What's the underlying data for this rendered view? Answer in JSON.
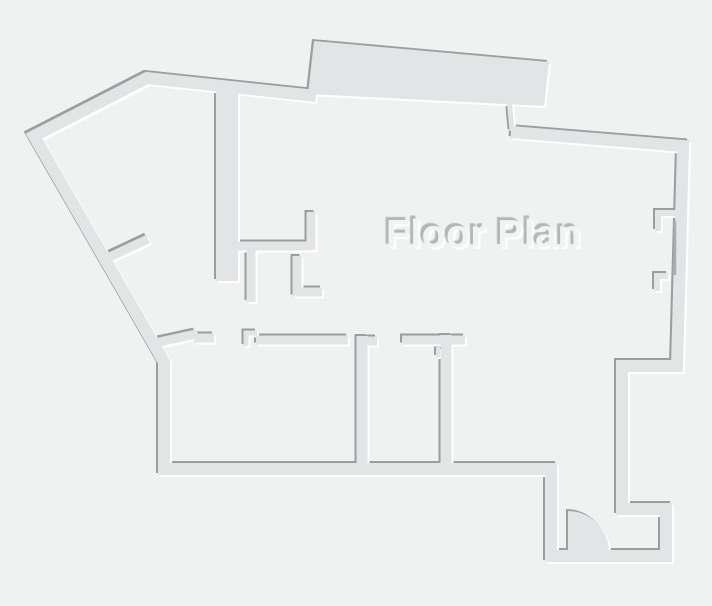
{
  "title": {
    "text": "Floor Plan"
  },
  "canvas": {
    "width": 712,
    "height": 606
  },
  "colors": {
    "background": "#f0f1f1",
    "wall": "#e2e4e5",
    "shadow_dark": "#9b9d9e",
    "shadow_light": "#ffffff",
    "title_fill": "#f2f3f3",
    "title_shadow": "#b5b7b7",
    "glazing_line": "#aaacad"
  },
  "floor_plan": {
    "outline_walls": [
      {
        "name": "exterior-outline",
        "d": "M 511,132 L 683,146 L 677,366 L 622,366 L 622,509 L 666,509 L 666,556 L 551,556 L 551,469 L 164,469 L 164,362 L 34,136 L 147,78 L 316,96",
        "width": 12
      },
      {
        "name": "slab-connector-wall",
        "d": "M 509,97 L 512,131",
        "width": 5
      },
      {
        "name": "interior-thick-wall",
        "d": "M 227,84 L 227,281",
        "width": 22
      },
      {
        "name": "closet-top-wall",
        "d": "M 238,246 L 311,246",
        "width": 9
      },
      {
        "name": "closet-upper-stub",
        "d": "M 311,250 L 311,212",
        "width": 9
      },
      {
        "name": "closet-left-stub",
        "d": "M 251,250 L 251,302",
        "width": 9
      },
      {
        "name": "closet-right-stub",
        "d": "M 297,256 L 297,292 L 322,292",
        "width": 9
      },
      {
        "name": "entry-diagonal-stub",
        "d": "M 101,261 L 148,239",
        "width": 9
      },
      {
        "name": "room1-diagonal-wall",
        "d": "M 150,344 L 196,334",
        "width": 9
      },
      {
        "name": "room1-top-wall",
        "d": "M 194,338 L 214,338",
        "width": 9
      },
      {
        "name": "room1-door-jamb",
        "d": "M 246,346 L 246,333 L 257,333",
        "width": 5
      },
      {
        "name": "room2-top-wall",
        "d": "M 256,340 L 348,340",
        "width": 9
      },
      {
        "name": "partition-wall-1",
        "d": "M 362,336 L 362,468",
        "width": 11
      },
      {
        "name": "partition-1-stub",
        "d": "M 357,341 L 377,341",
        "width": 9
      },
      {
        "name": "room3-top-wall",
        "d": "M 402,340 L 465,340",
        "width": 9
      },
      {
        "name": "room3-mini-stub",
        "d": "M 438,347 L 438,357",
        "width": 4
      },
      {
        "name": "partition-wall-2",
        "d": "M 446,335 L 446,468",
        "width": 11
      },
      {
        "name": "window-jamb-top",
        "d": "M 679,213 L 658,213 L 658,231",
        "width": 6
      },
      {
        "name": "window-jamb-bottom",
        "d": "M 668,276 L 657,276 L 657,291",
        "width": 6
      }
    ],
    "solid_shapes": [
      {
        "name": "top-slab",
        "d": "M 308,94 L 314,41 L 549,62 L 544,106 Z"
      },
      {
        "name": "door-swing",
        "d": "M 568,552 L 568,511 A 41,41 0 0 1 609,552 Z"
      }
    ],
    "thin_lines": [
      {
        "name": "window-glazing-line",
        "d": "M 675,221 L 675,275",
        "width": 2.5
      }
    ]
  }
}
